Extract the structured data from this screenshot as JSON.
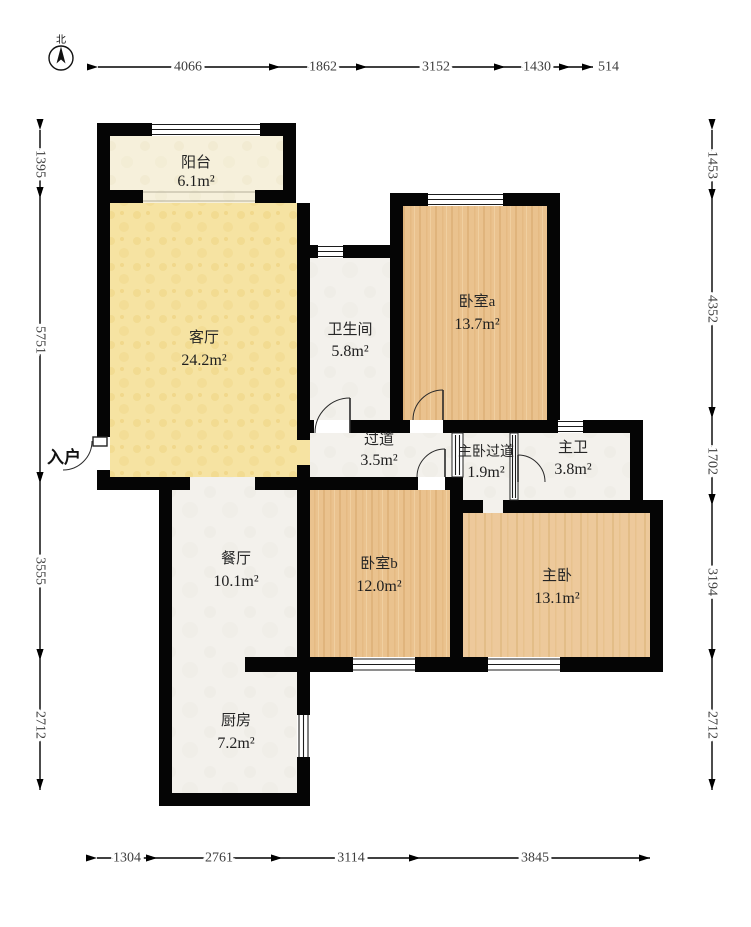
{
  "compass": {
    "label": "北"
  },
  "entrance": {
    "label": "入户"
  },
  "rooms": {
    "balcony": {
      "name": "阳台",
      "area": "6.1m²"
    },
    "living": {
      "name": "客厅",
      "area": "24.2m²"
    },
    "bathroom": {
      "name": "卫生间",
      "area": "5.8m²"
    },
    "bedroom_a": {
      "name": "卧室a",
      "area": "13.7m²"
    },
    "hallway": {
      "name": "过道",
      "area": "3.5m²"
    },
    "master_hallway": {
      "name": "主卧过道",
      "area": "1.9m²"
    },
    "master_bath": {
      "name": "主卫",
      "area": "3.8m²"
    },
    "dining": {
      "name": "餐厅",
      "area": "10.1m²"
    },
    "bedroom_b": {
      "name": "卧室b",
      "area": "12.0m²"
    },
    "master_bedroom": {
      "name": "主卧",
      "area": "13.1m²"
    },
    "kitchen": {
      "name": "厨房",
      "area": "7.2m²"
    }
  },
  "dimensions": {
    "top": [
      "4066",
      "1862",
      "3152",
      "1430",
      "514"
    ],
    "left": [
      "1395",
      "5751",
      "3555",
      "2712"
    ],
    "right": [
      "1453",
      "4352",
      "1702",
      "3194",
      "2712"
    ],
    "bottom": [
      "1304",
      "2761",
      "3114",
      "3845"
    ]
  },
  "colors": {
    "wall": "#050505",
    "living_floor": "#f6e3a2",
    "balcony_floor": "#f6f0db",
    "wood_floor": "#eac28e",
    "wood_floor_light": "#edc99b",
    "tile_floor": "#f3f1ec"
  }
}
